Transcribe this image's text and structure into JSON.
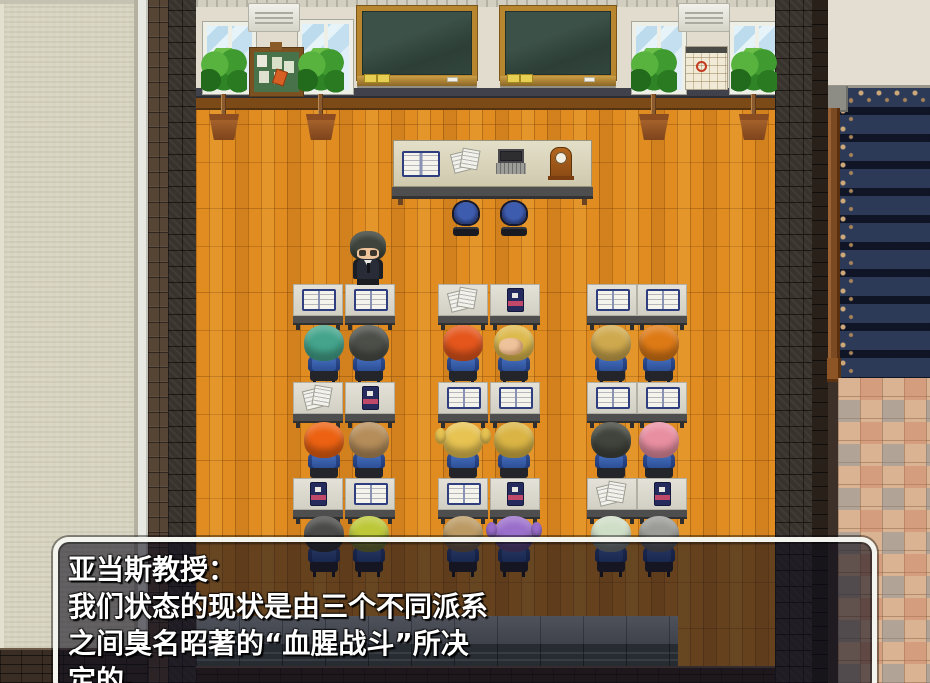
{
  "dialog": {
    "speaker": "亚当斯教授：",
    "lines": [
      "我们状态的现状是由三个不同派系",
      "之间臭名昭著的“血腥战斗”所决",
      "定的。"
    ]
  },
  "scene": {
    "professor": {
      "name": "professor-adams-sprite",
      "hair_color": "#3f453c",
      "suit_color": "#282c36"
    },
    "students": [
      {
        "id": "r1s1",
        "hair": "teal-spiky",
        "hair_color": "#44a58c"
      },
      {
        "id": "r1s2",
        "hair": "dark-gray-long",
        "hair_color": "#4c4f48"
      },
      {
        "id": "r1s3",
        "hair": "orange-red-spiky",
        "hair_color": "#e4561c"
      },
      {
        "id": "r1s4",
        "hair": "blond-mohawk",
        "hair_color": "#ddba4e"
      },
      {
        "id": "r1s5",
        "hair": "sandy-blond",
        "hair_color": "#cfa94e"
      },
      {
        "id": "r1s6",
        "hair": "orange-curly",
        "hair_color": "#de7a16"
      },
      {
        "id": "r2s1",
        "hair": "orange-flame",
        "hair_color": "#ec6212"
      },
      {
        "id": "r2s2",
        "hair": "sandy-brown",
        "hair_color": "#b58d5a"
      },
      {
        "id": "r2s3",
        "hair": "blonde-pigtails",
        "hair_color": "#e7c352"
      },
      {
        "id": "r2s4",
        "hair": "blond-shaggy",
        "hair_color": "#dab545"
      },
      {
        "id": "r2s5",
        "hair": "dark-gray",
        "hair_color": "#41443c"
      },
      {
        "id": "r2s6",
        "hair": "pink",
        "hair_color": "#e98fa2"
      },
      {
        "id": "r3s1",
        "hair": "dark-gray",
        "hair_color": "#4a4a48"
      },
      {
        "id": "r3s2",
        "hair": "yellow-green",
        "hair_color": "#bcc838"
      },
      {
        "id": "r3s3",
        "hair": "sandy-brown",
        "hair_color": "#bb9a64"
      },
      {
        "id": "r3s4",
        "hair": "purple",
        "hair_color": "#9a6ecb"
      },
      {
        "id": "r3s5",
        "hair": "pale-green",
        "hair_color": "#cfdec6"
      },
      {
        "id": "r3s6",
        "hair": "gray",
        "hair_color": "#9b9b97"
      }
    ],
    "desk_items": [
      [
        "open-book",
        "open-book",
        "papers",
        "closed-book",
        "open-book",
        "open-book"
      ],
      [
        "papers",
        "closed-book",
        "open-book",
        "open-book",
        "open-book",
        "open-book"
      ],
      [
        "closed-book",
        "open-book",
        "open-book",
        "closed-book",
        "papers",
        "closed-book"
      ]
    ],
    "teacher_desk_items": [
      "open-book",
      "papers",
      "laptop",
      "clock"
    ],
    "wall_objects": [
      "window",
      "air-conditioner",
      "bulletin-board",
      "window",
      "blackboard",
      "blackboard",
      "window",
      "air-conditioner",
      "calendar",
      "window"
    ],
    "plant_count": 4,
    "palette": {
      "floor_wood": "#e08c20",
      "wall": "#e1dccd",
      "uniform_blue": "#3a64b8",
      "carpet_navy": "#2c3a58",
      "tile_floor": "#d9b392",
      "dialog_border": "#f4f4ee"
    }
  }
}
